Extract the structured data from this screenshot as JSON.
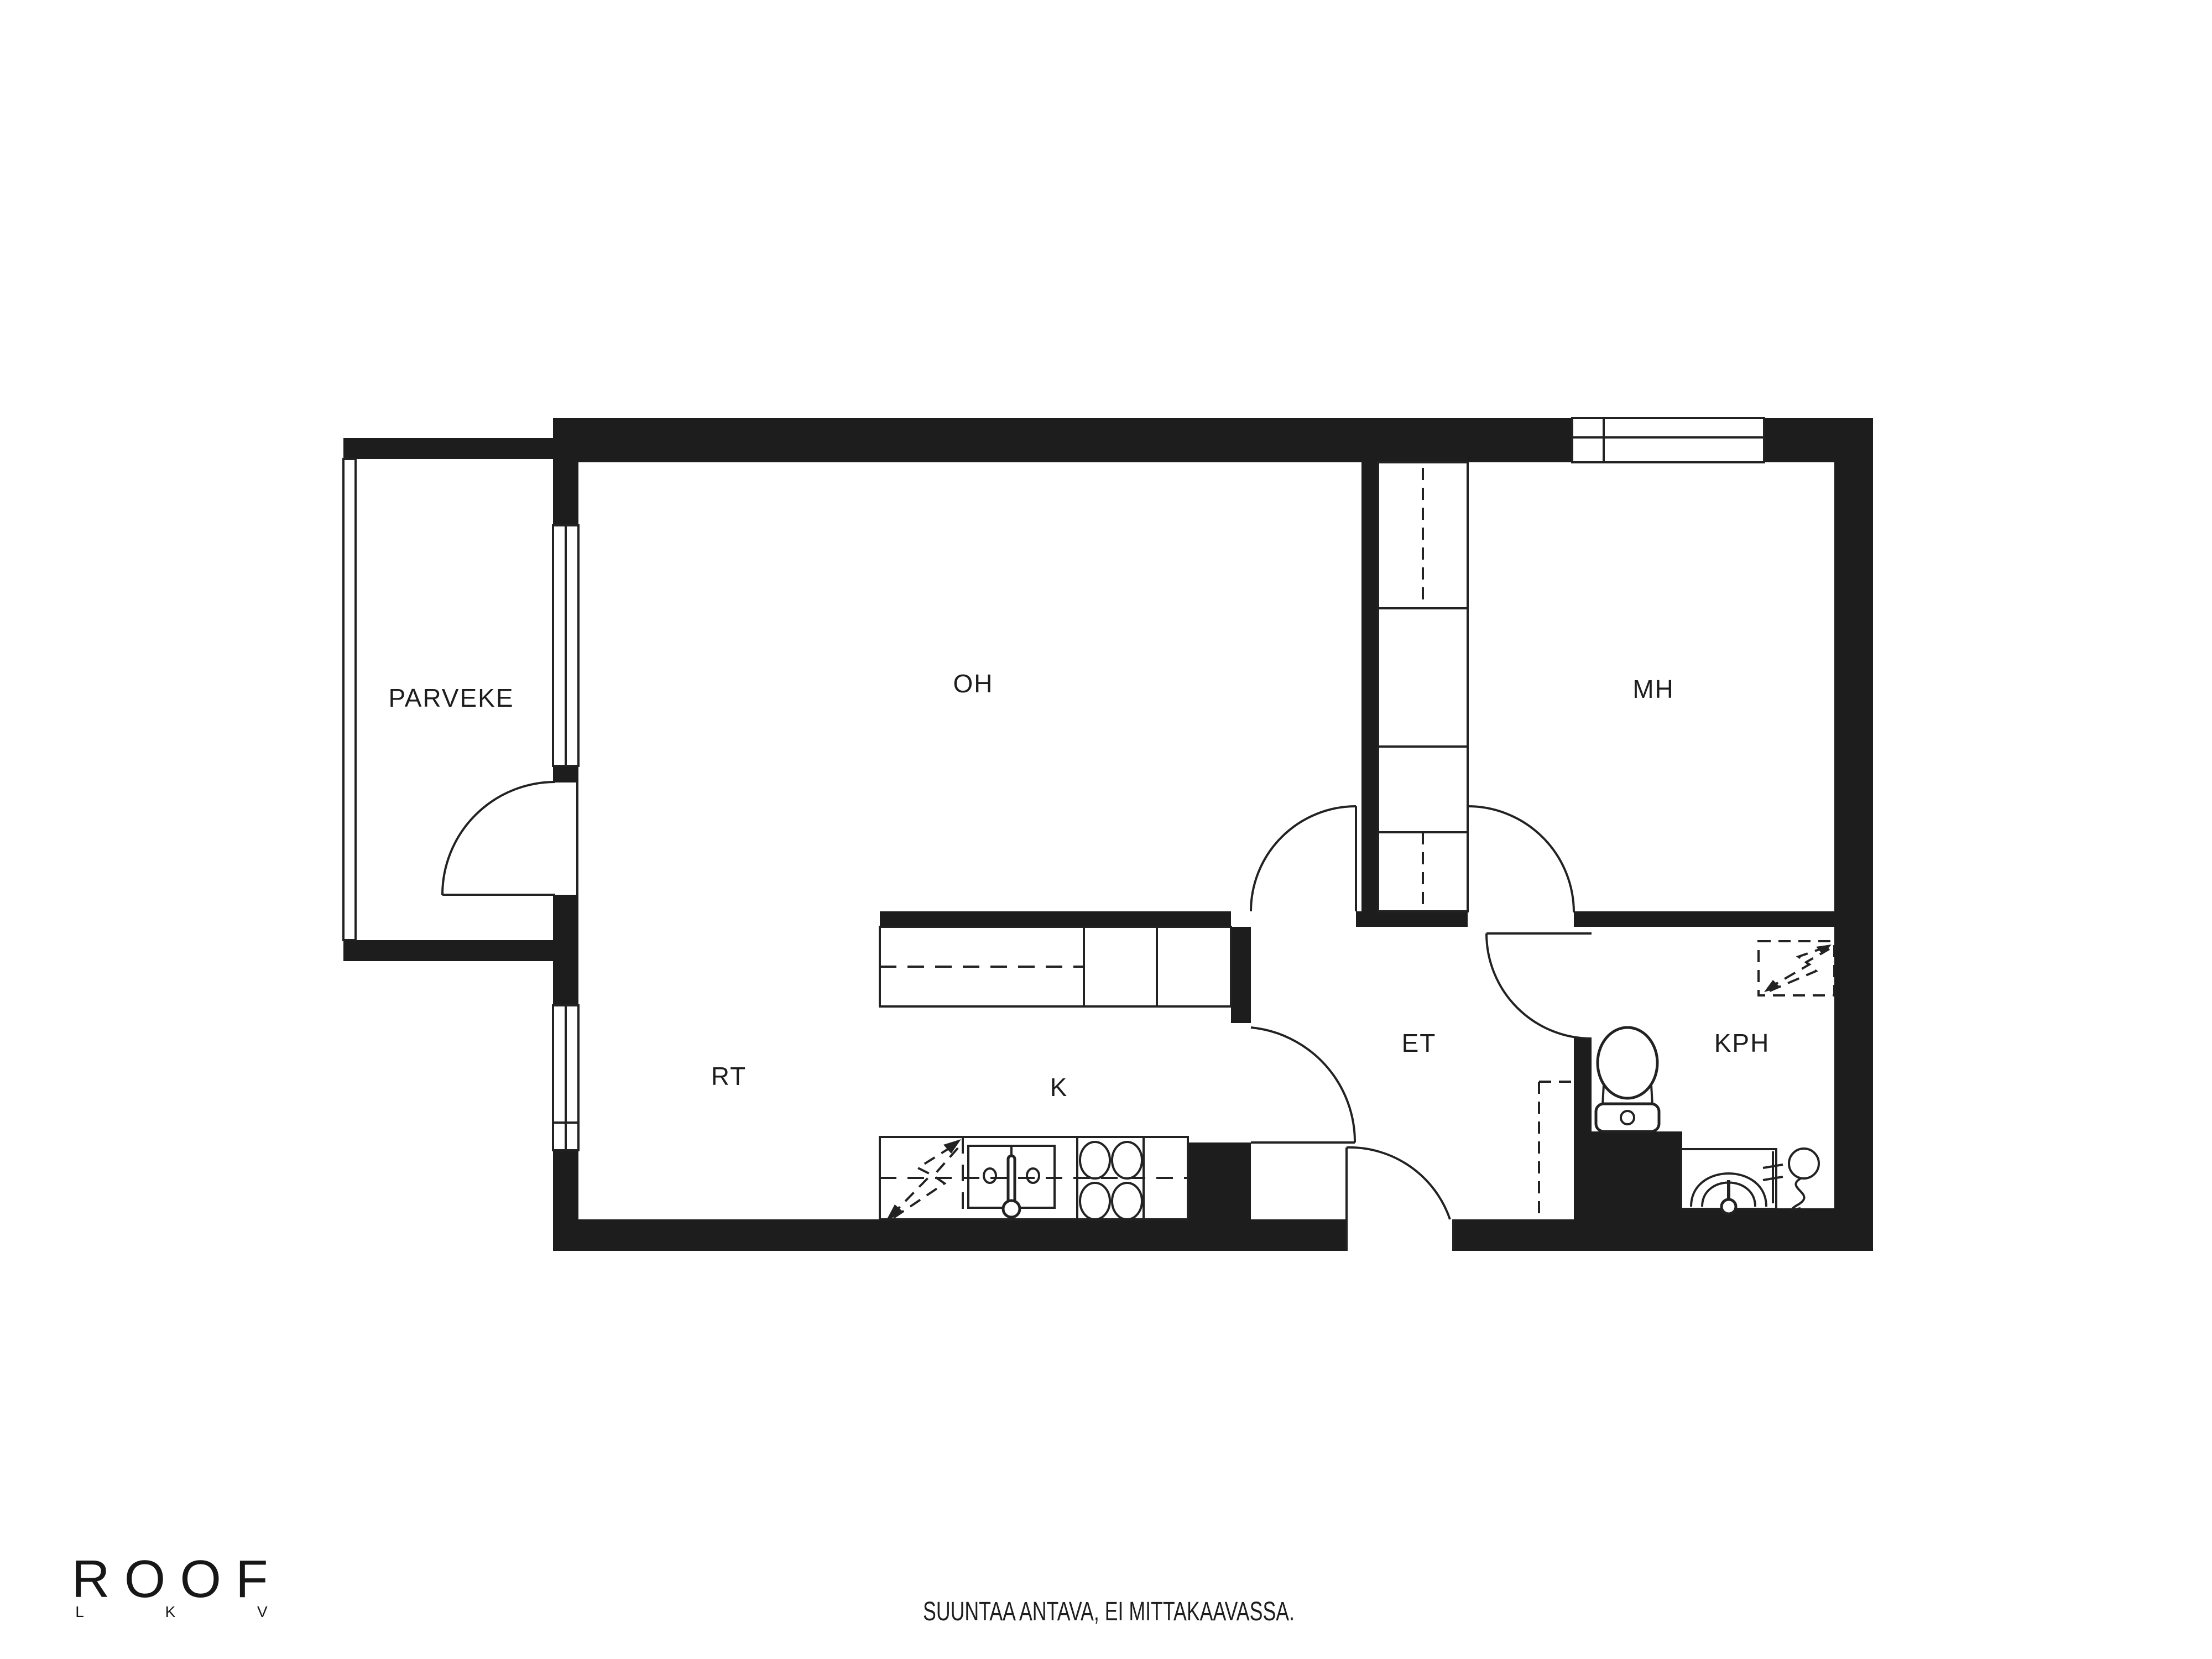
{
  "colors": {
    "background": "#ffffff",
    "walls": "#1d1d1d",
    "lines": "#222222"
  },
  "rooms": [
    {
      "id": "parveke",
      "label": "PARVEKE"
    },
    {
      "id": "oh",
      "label": "OH"
    },
    {
      "id": "mh",
      "label": "MH"
    },
    {
      "id": "rt",
      "label": "RT"
    },
    {
      "id": "k",
      "label": "K"
    },
    {
      "id": "et",
      "label": "ET"
    },
    {
      "id": "kph",
      "label": "KPH"
    }
  ],
  "symbols": [
    "window",
    "balcony-railing",
    "door-swing",
    "wardrobe-column",
    "kitchen-counter",
    "sink",
    "stove-burners",
    "appliance-reservation-lightning",
    "toilet",
    "washbasin",
    "shower-hose",
    "electrical-reservation-lightning",
    "closet-reservation-dashed"
  ],
  "branding": {
    "logo": "ROOF",
    "logo_sub": "L K V"
  },
  "footer": {
    "disclaimer": "SUUNTAA ANTAVA, EI MITTAKAAVASSA."
  }
}
